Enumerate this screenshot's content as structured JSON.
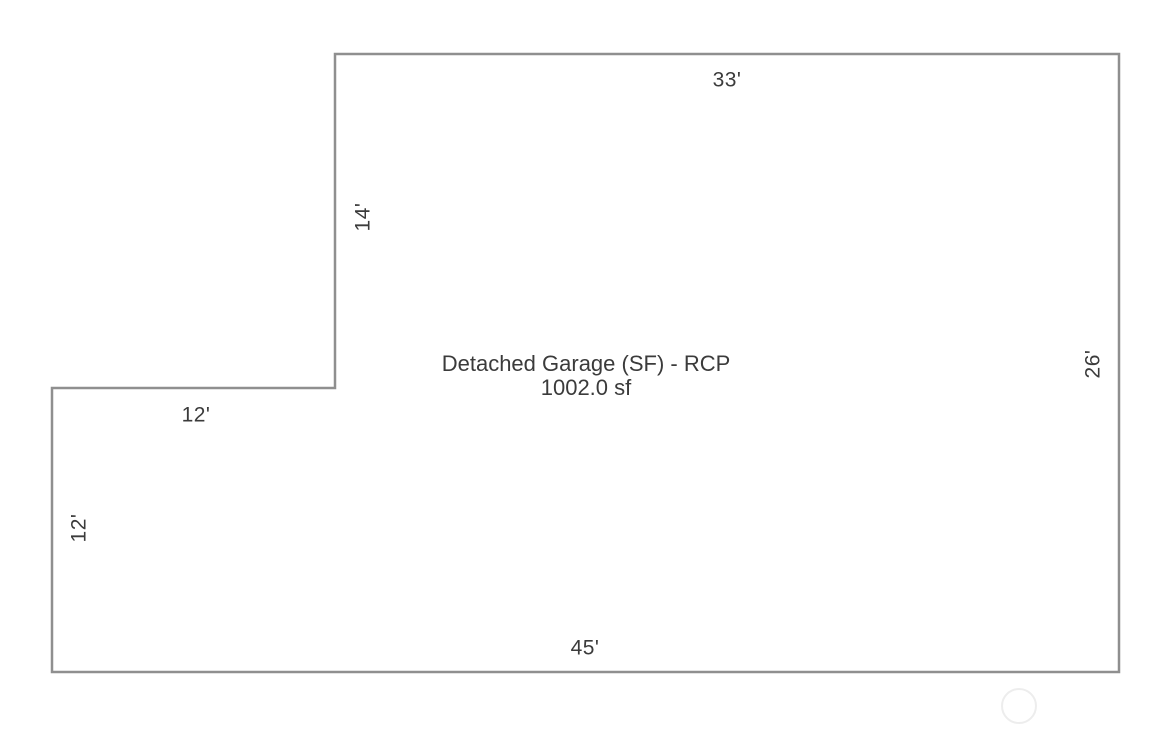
{
  "floorplan": {
    "title": "Detached Garage (SF) - RCP",
    "area": "1002.0 sf",
    "outline_color": "#8f8f8f",
    "text_color": "#3b3b3b",
    "watermark_color": "#ededed",
    "polygon_points": "335,54 1119,54 1119,672 52,672 52,388 335,388",
    "dimensions": {
      "top_width": "33'",
      "step_height": "14'",
      "notch_width": "12'",
      "left_height": "12'",
      "bottom_width": "45'",
      "right_height": "26'"
    }
  }
}
